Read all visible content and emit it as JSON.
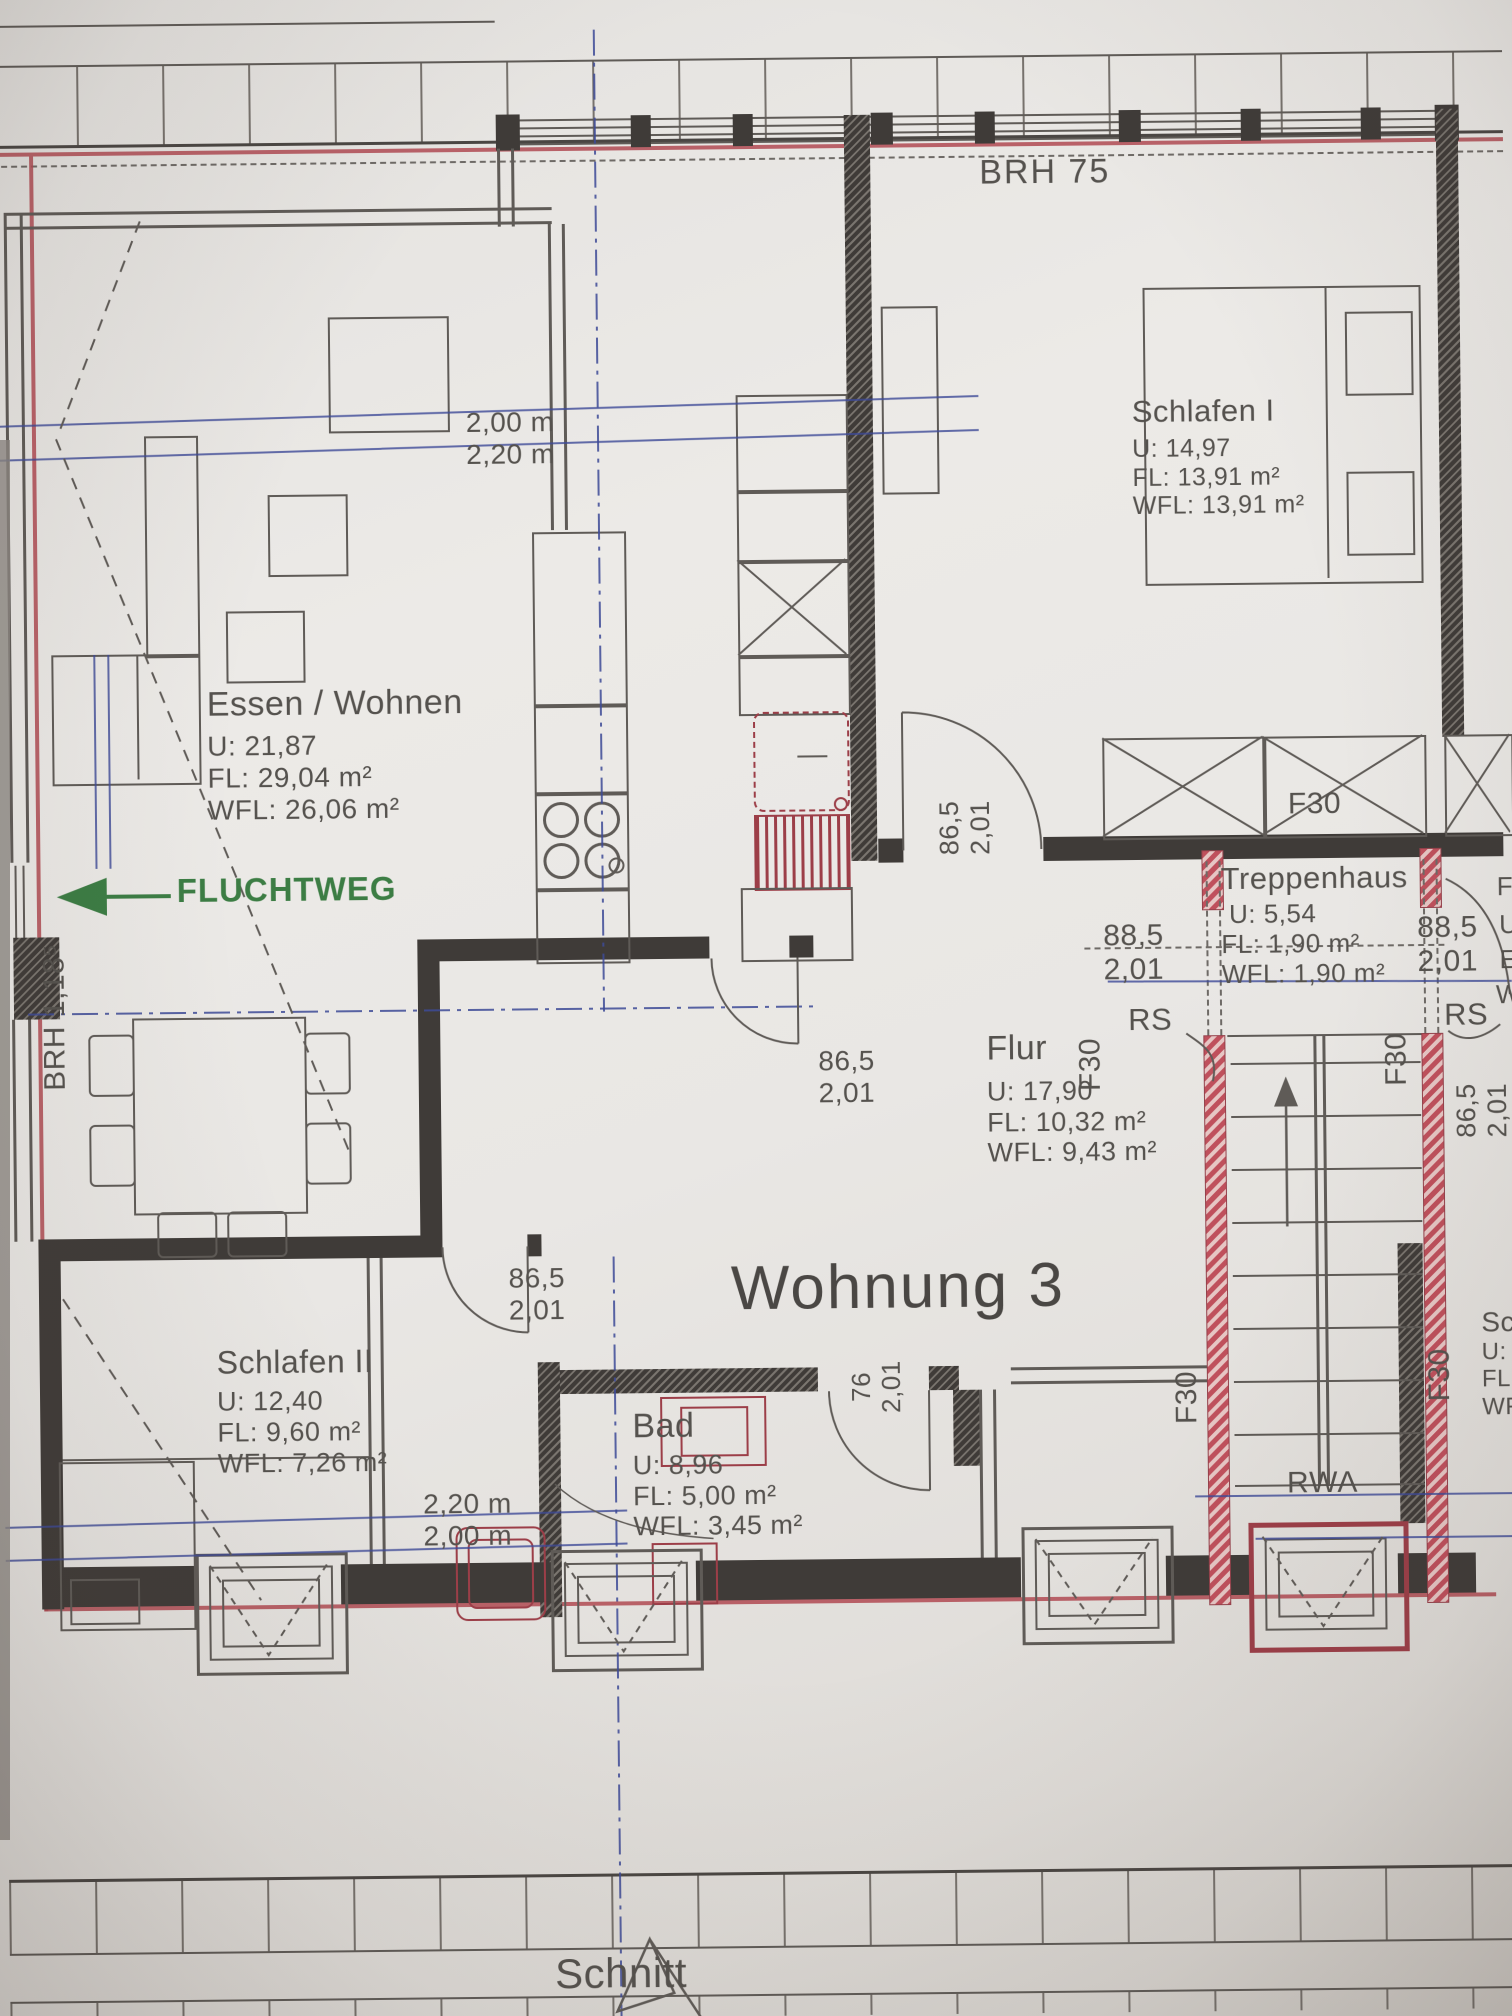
{
  "colors": {
    "ink": "#55524e",
    "red": "#b04a52",
    "blue": "#3d4a97",
    "green": "#3c7d44"
  },
  "apartment": {
    "title": "Wohnung 3"
  },
  "rooms": {
    "essen": {
      "name": "Essen / Wohnen",
      "u": "U: 21,87",
      "fl": "FL: 29,04 m²",
      "wfl": "WFL: 26,06 m²"
    },
    "schlafen1": {
      "name": "Schlafen I",
      "u": "U: 14,97",
      "fl": "FL: 13,91 m²",
      "wfl": "WFL: 13,91 m²"
    },
    "schlafen2": {
      "name": "Schlafen II",
      "u": "U: 12,40",
      "fl": "FL: 9,60 m²",
      "wfl": "WFL: 7,26 m²"
    },
    "bad": {
      "name": "Bad",
      "u": "U: 8,96",
      "fl": "FL: 5,00 m²",
      "wfl": "WFL: 3,45 m²"
    },
    "flur": {
      "name": "Flur",
      "u": "U: 17,90",
      "fl": "FL: 10,32 m²",
      "wfl": "WFL: 9,43 m²"
    },
    "treppenhaus": {
      "name": "Treppenhaus",
      "u": "U: 5,54",
      "fl": "FL: 1,90 m²",
      "wfl": "WFL: 1,90 m²"
    }
  },
  "annotations": {
    "brh_top": "BRH 75",
    "brh_left": "BRH 1,18⁵",
    "fluchtweg": "FLUCHTWEG",
    "dim_top_1": "2,00 m",
    "dim_top_2": "2,20 m",
    "dim_bottom_1": "2,20 m",
    "dim_bottom_2": "2,00 m",
    "door_w_865": "86,5",
    "door_w_885": "88,5",
    "door_w_76": "76",
    "door_h": "2,01",
    "f30": "F30",
    "rs": "RS",
    "rwa": "RWA",
    "schnitt": "Schnitt"
  },
  "edge_partials": {
    "a": "F",
    "b": "U",
    "c": "E",
    "d": "W",
    "room_name": "Sc",
    "room_u": "U: 1",
    "room_fl": "FL:",
    "room_wfl": "WF"
  }
}
